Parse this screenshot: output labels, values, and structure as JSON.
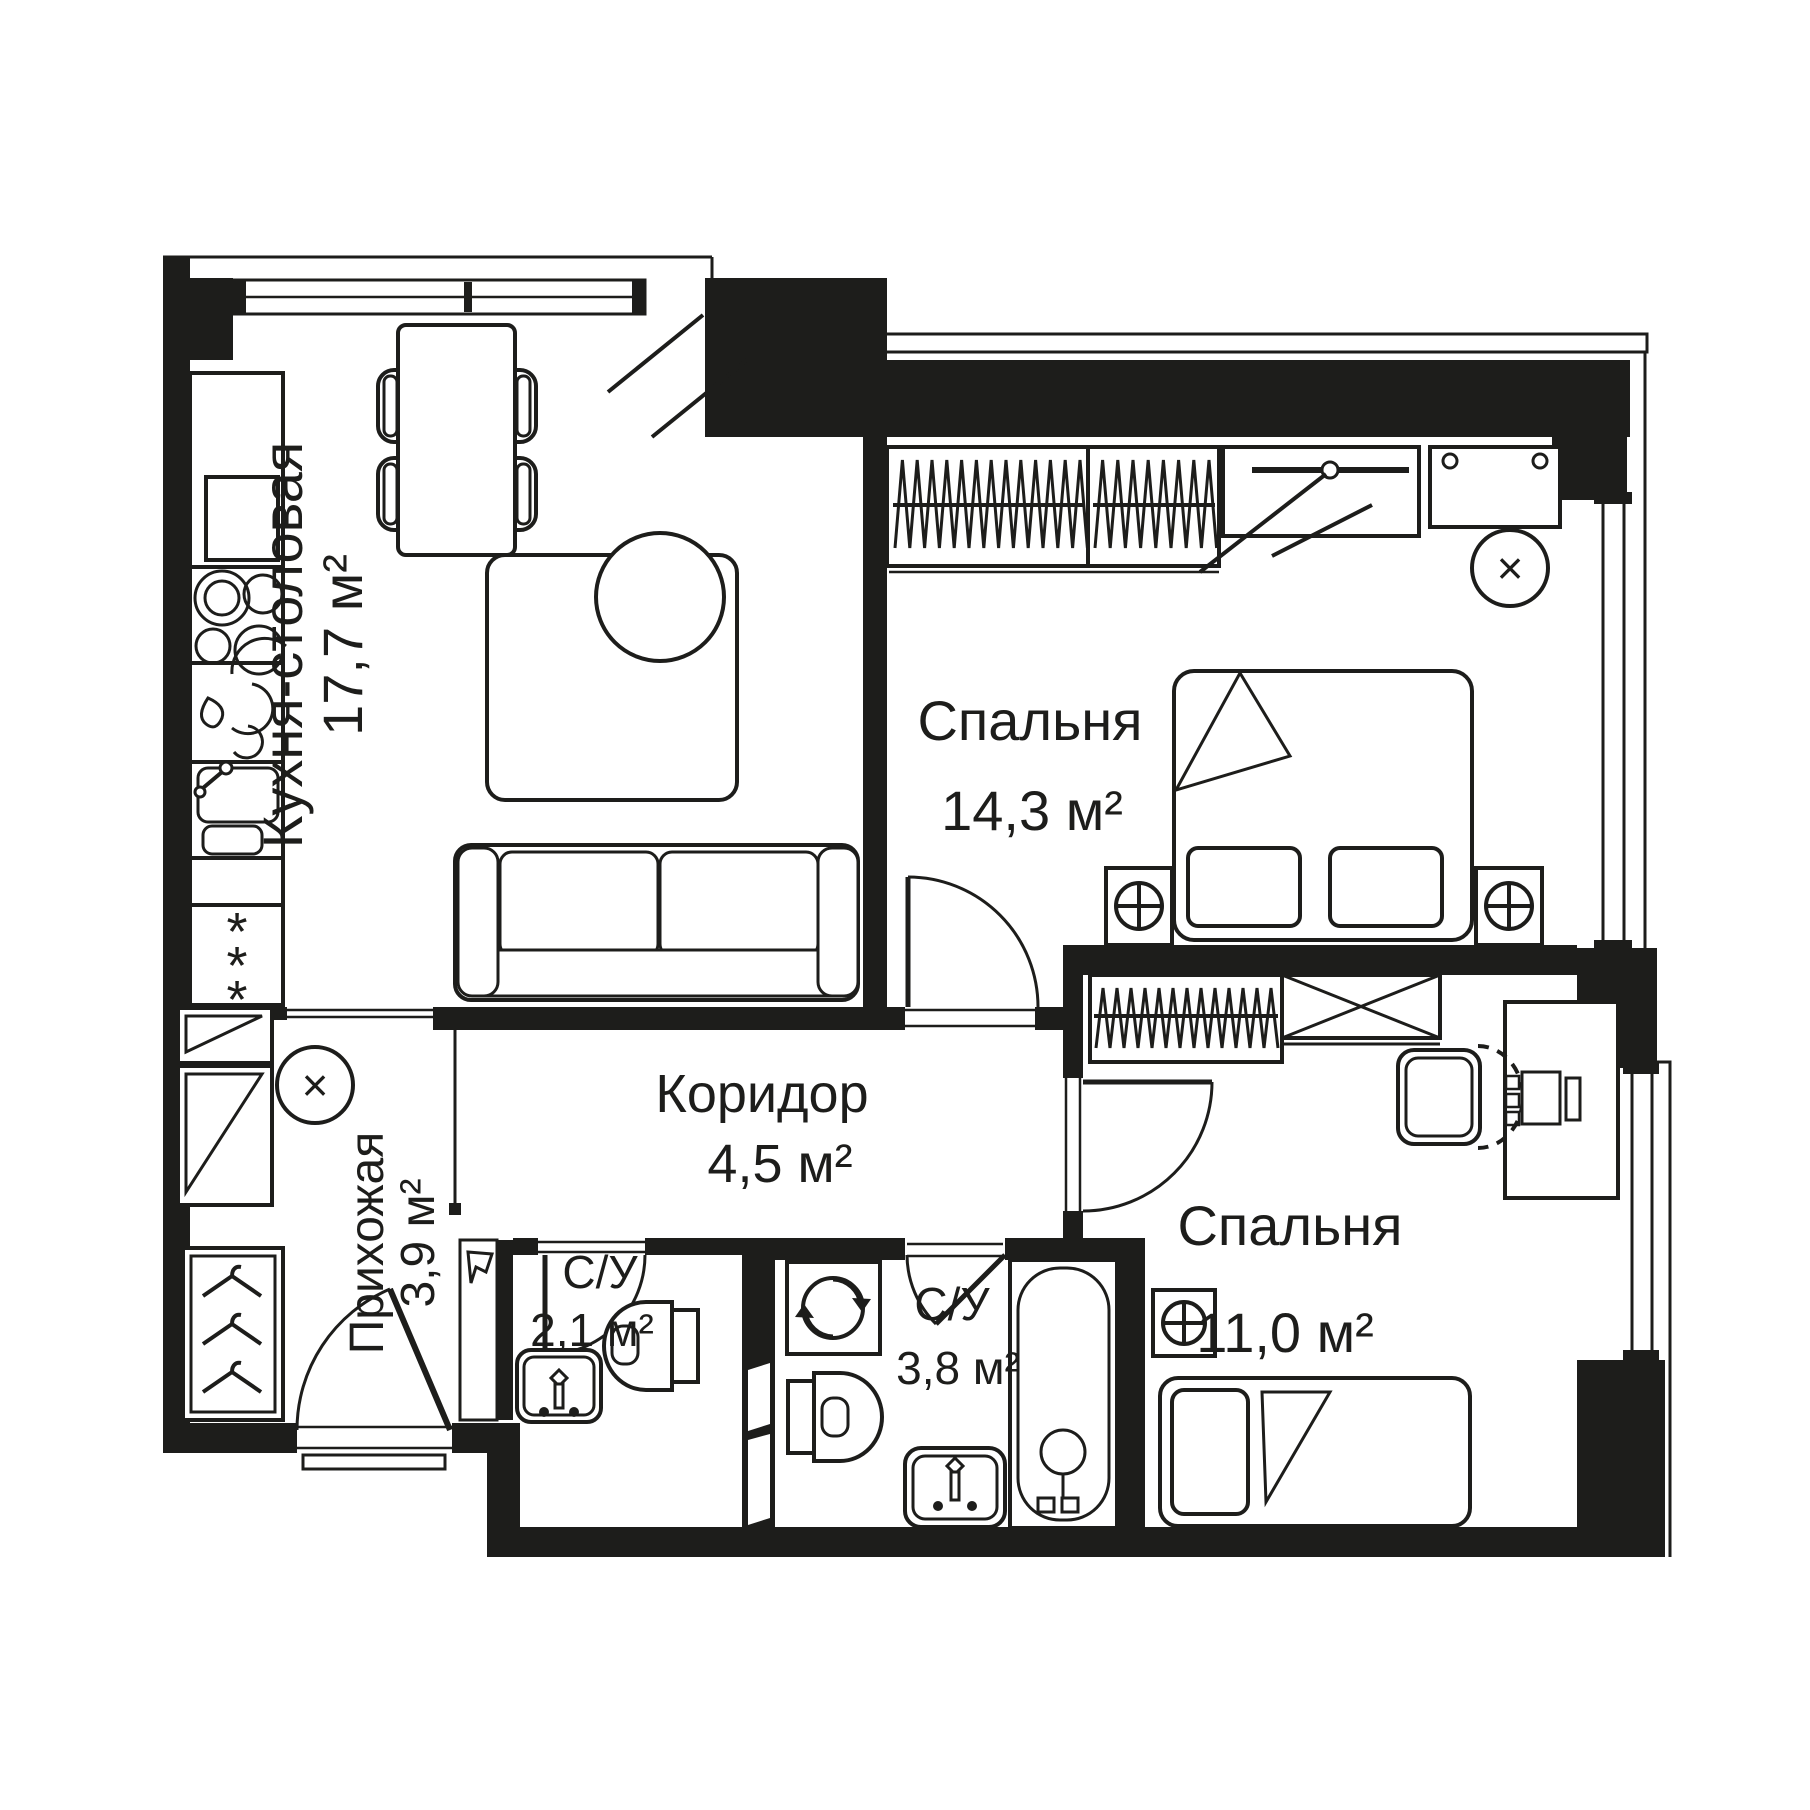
{
  "plan": {
    "colors": {
      "walls": "#1d1d1b",
      "background": "#ffffff"
    },
    "rooms": [
      {
        "name": "Кухня-столовая",
        "area_label": "17,7 м²"
      },
      {
        "name": "Спальня",
        "area_label": "14,3 м²"
      },
      {
        "name": "Прихожая",
        "area_label": "3,9 м²"
      },
      {
        "name": "Коридор",
        "area_label": "4,5 м²"
      },
      {
        "name": "С/У",
        "area_label": "2,1 м²"
      },
      {
        "name": "С/У",
        "area_label": "3,8 м²"
      },
      {
        "name": "Спальня",
        "area_label": "11,0 м²"
      }
    ],
    "icons": {
      "vent": "×",
      "fridge_star": "*"
    }
  }
}
